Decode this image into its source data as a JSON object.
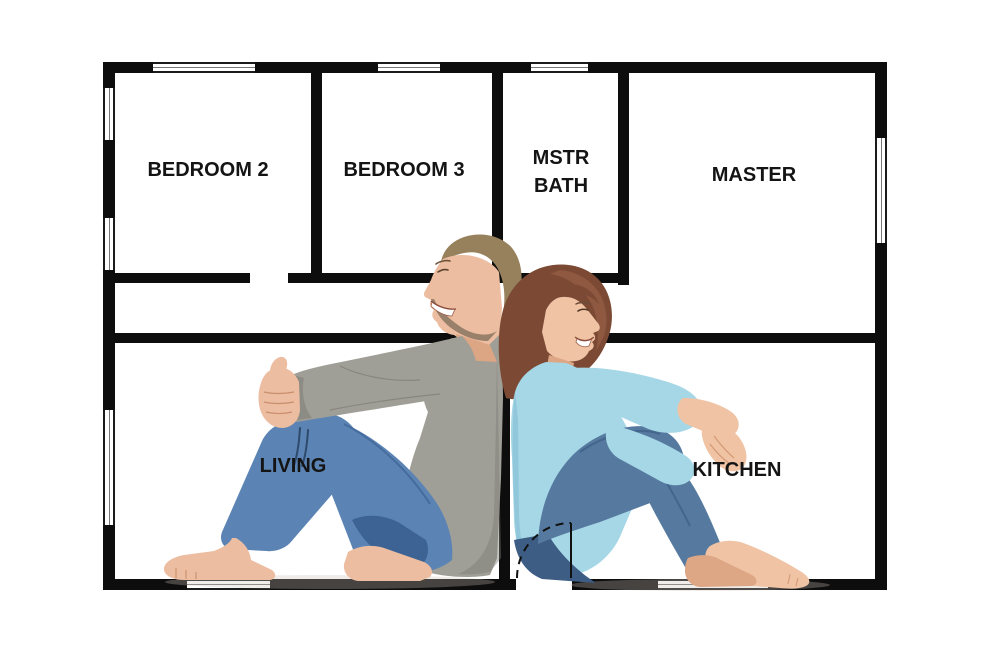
{
  "floorplan": {
    "wall_color": "#0d0d0d",
    "window_frame_color": "#1b1b1b",
    "label_color": "#141414",
    "labels": {
      "bedroom2": "BEDROOM 2",
      "bedroom3": "BEDROOM 3",
      "mstr_bath_line1": "MSTR",
      "mstr_bath_line2": "BATH",
      "master": "MASTER",
      "living": "LIVING",
      "kitchen": "KITCHEN"
    }
  },
  "figures": {
    "man": {
      "hair": "#97805c",
      "skin": "#ecbda0",
      "skin_shadow": "#dca583",
      "beard": "#8a7560",
      "shirt": "#a09f97",
      "shirt_shadow": "#7d7c74",
      "jeans": "#5b84b5",
      "jeans_dark": "#3d6394"
    },
    "woman": {
      "hair": "#7c4a34",
      "hair_light": "#9a6046",
      "skin": "#f0c3a4",
      "skin_shadow": "#dda684",
      "sweater": "#a6d7e6",
      "sweater_shadow": "#7fb9cf",
      "jeans": "#567a9f",
      "jeans_dark": "#3d5d85"
    },
    "floor_shadow": "#c9c0b8"
  }
}
